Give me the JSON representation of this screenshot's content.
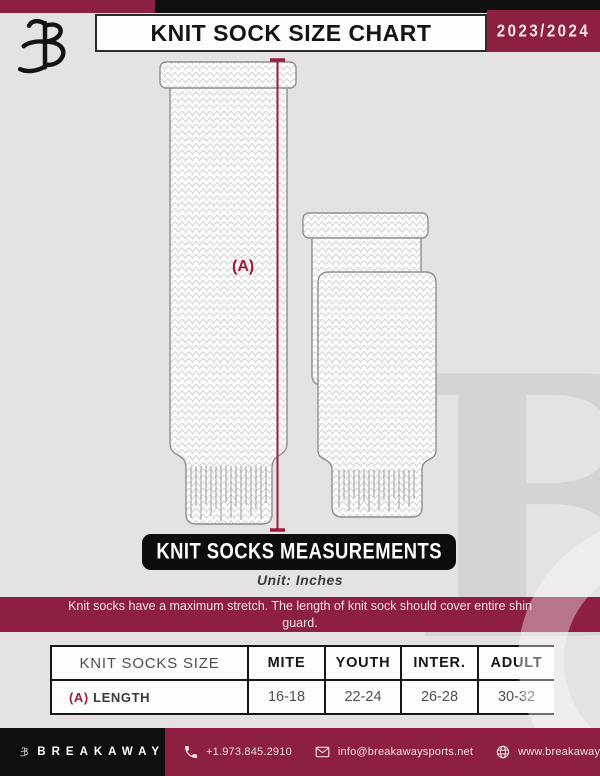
{
  "header": {
    "title": "KNIT SOCK SIZE CHART",
    "season": "2023/2024"
  },
  "diagram": {
    "measure_label": "(A)"
  },
  "measurements": {
    "banner": "KNIT SOCKS MEASUREMENTS",
    "unit": "Unit: Inches",
    "note": "Knit socks have a maximum stretch. The length of knit sock should cover entire shin guard."
  },
  "table": {
    "size_label": "KNIT SOCKS SIZE",
    "columns": [
      "MITE",
      "YOUTH",
      "INTER.",
      "ADULT"
    ],
    "rows": [
      {
        "key": "(A)",
        "label": "LENGTH",
        "values": [
          "16-18",
          "22-24",
          "26-28",
          "30-32"
        ]
      }
    ]
  },
  "footer": {
    "brand": "BREAKAWAY",
    "phone": "+1.973.845.2910",
    "email": "info@breakawaysports.net",
    "website": "www.breakawaysports.net"
  },
  "colors": {
    "accent_maroon": "#8D2040",
    "measure_line": "#9E1B3C",
    "background": "#E4E3E1",
    "banner_black": "#0D0D0D"
  }
}
